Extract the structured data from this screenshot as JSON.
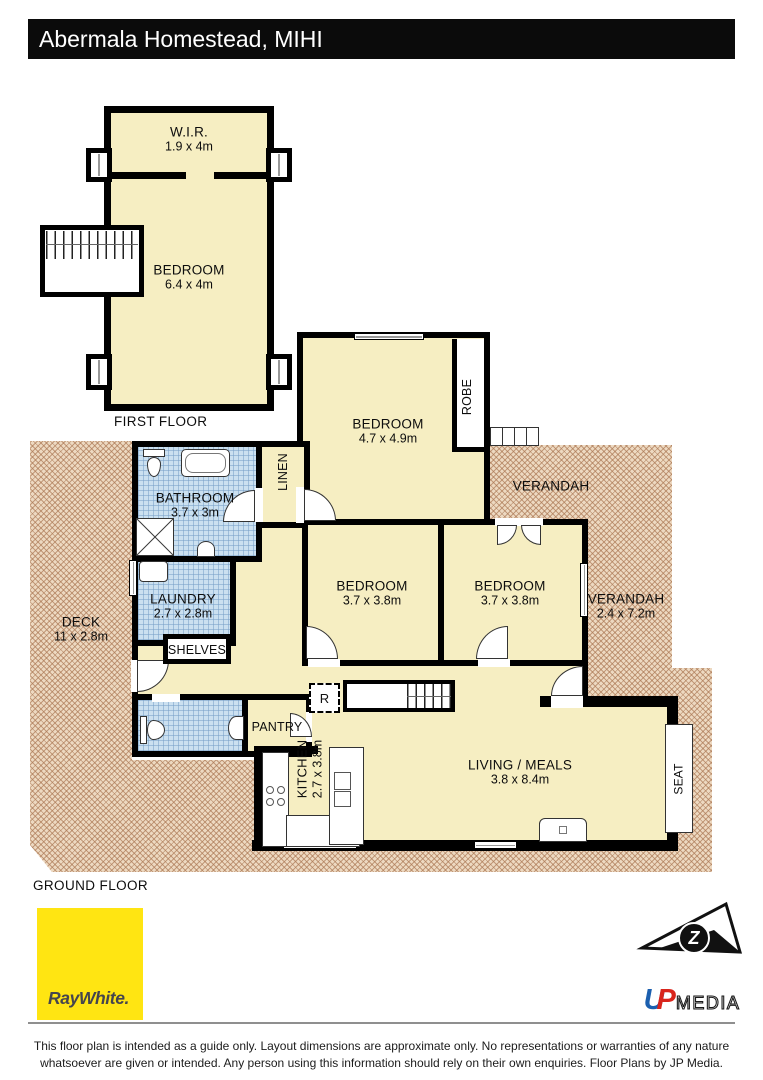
{
  "header": {
    "title": "Abermala Homestead, MIHI"
  },
  "first_floor": {
    "caption": "FIRST FLOOR",
    "wir": {
      "name": "W.I.R.",
      "dims": "1.9 x 4m"
    },
    "bedroom": {
      "name": "BEDROOM",
      "dims": "6.4 x 4m"
    }
  },
  "ground_floor": {
    "caption": "GROUND FLOOR",
    "bedroom_main": {
      "name": "BEDROOM",
      "dims": "4.7 x 4.9m"
    },
    "robe": {
      "name": "ROBE"
    },
    "linen": {
      "name": "LINEN"
    },
    "bathroom": {
      "name": "BATHROOM",
      "dims": "3.7 x 3m"
    },
    "laundry": {
      "name": "LAUNDRY",
      "dims": "2.7 x 2.8m"
    },
    "shelves": {
      "name": "SHELVES"
    },
    "deck": {
      "name": "DECK",
      "dims": "11 x 2.8m"
    },
    "verandah_top": {
      "name": "VERANDAH"
    },
    "verandah_right": {
      "name": "VERANDAH",
      "dims": "2.4 x 7.2m"
    },
    "bedroom_left": {
      "name": "BEDROOM",
      "dims": "3.7 x 3.8m"
    },
    "bedroom_right": {
      "name": "BEDROOM",
      "dims": "3.7 x 3.8m"
    },
    "pantry": {
      "name": "PANTRY"
    },
    "fridge": {
      "label": "R"
    },
    "kitchen": {
      "name": "KITCHEN",
      "dims": "2.7 x 3.8m"
    },
    "living": {
      "name": "LIVING / MEALS",
      "dims": "3.8 x 8.4m"
    },
    "seat": {
      "name": "SEAT"
    }
  },
  "footer": {
    "ray_white_logo": "RayWhite.",
    "jp_logo_letter": "Z",
    "jp_u": "U",
    "jp_p": "P",
    "jp_media": "MEDIA",
    "disclaimer_line1": "This floor plan is intended as a guide only. Layout dimensions are approximate only. No representations or warranties of any nature",
    "disclaimer_line2": "whatsoever are given or intended. Any person using this information should rely on their own enquiries. Floor Plans by JP Media."
  },
  "colors": {
    "wall": "#000000",
    "cream": "#F6EEC2",
    "wet": "#CBE0F0",
    "hatch_bg": "#EDD9C1",
    "hatch_line": "#C09271",
    "header_bg": "#0B0B0B",
    "yellow": "#FFE512",
    "ray_white_text": "#45454E",
    "jp_blue": "#1B5FAF",
    "jp_red": "#D9251C"
  }
}
